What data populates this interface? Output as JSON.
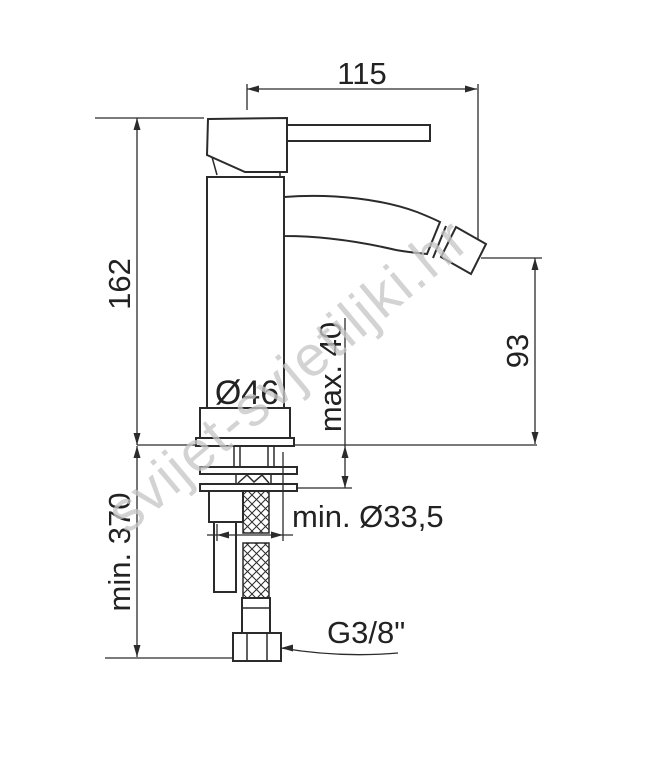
{
  "title": "Bidet single-lever mixer — installation dimension drawing",
  "watermark": "svijet-svjetiljki.hr",
  "drawing": {
    "type": "technical-dimension-diagram",
    "units": "mm",
    "dimensions": {
      "spout_reach": "115",
      "body_height": "162",
      "spout_outlet_height": "93",
      "max_deck_thickness": "max. 40",
      "base_diameter": "Ø46",
      "min_hose_length": "min. 370",
      "min_hole_diameter": "min. Ø33,5",
      "connection_thread": "G3/8\""
    }
  }
}
